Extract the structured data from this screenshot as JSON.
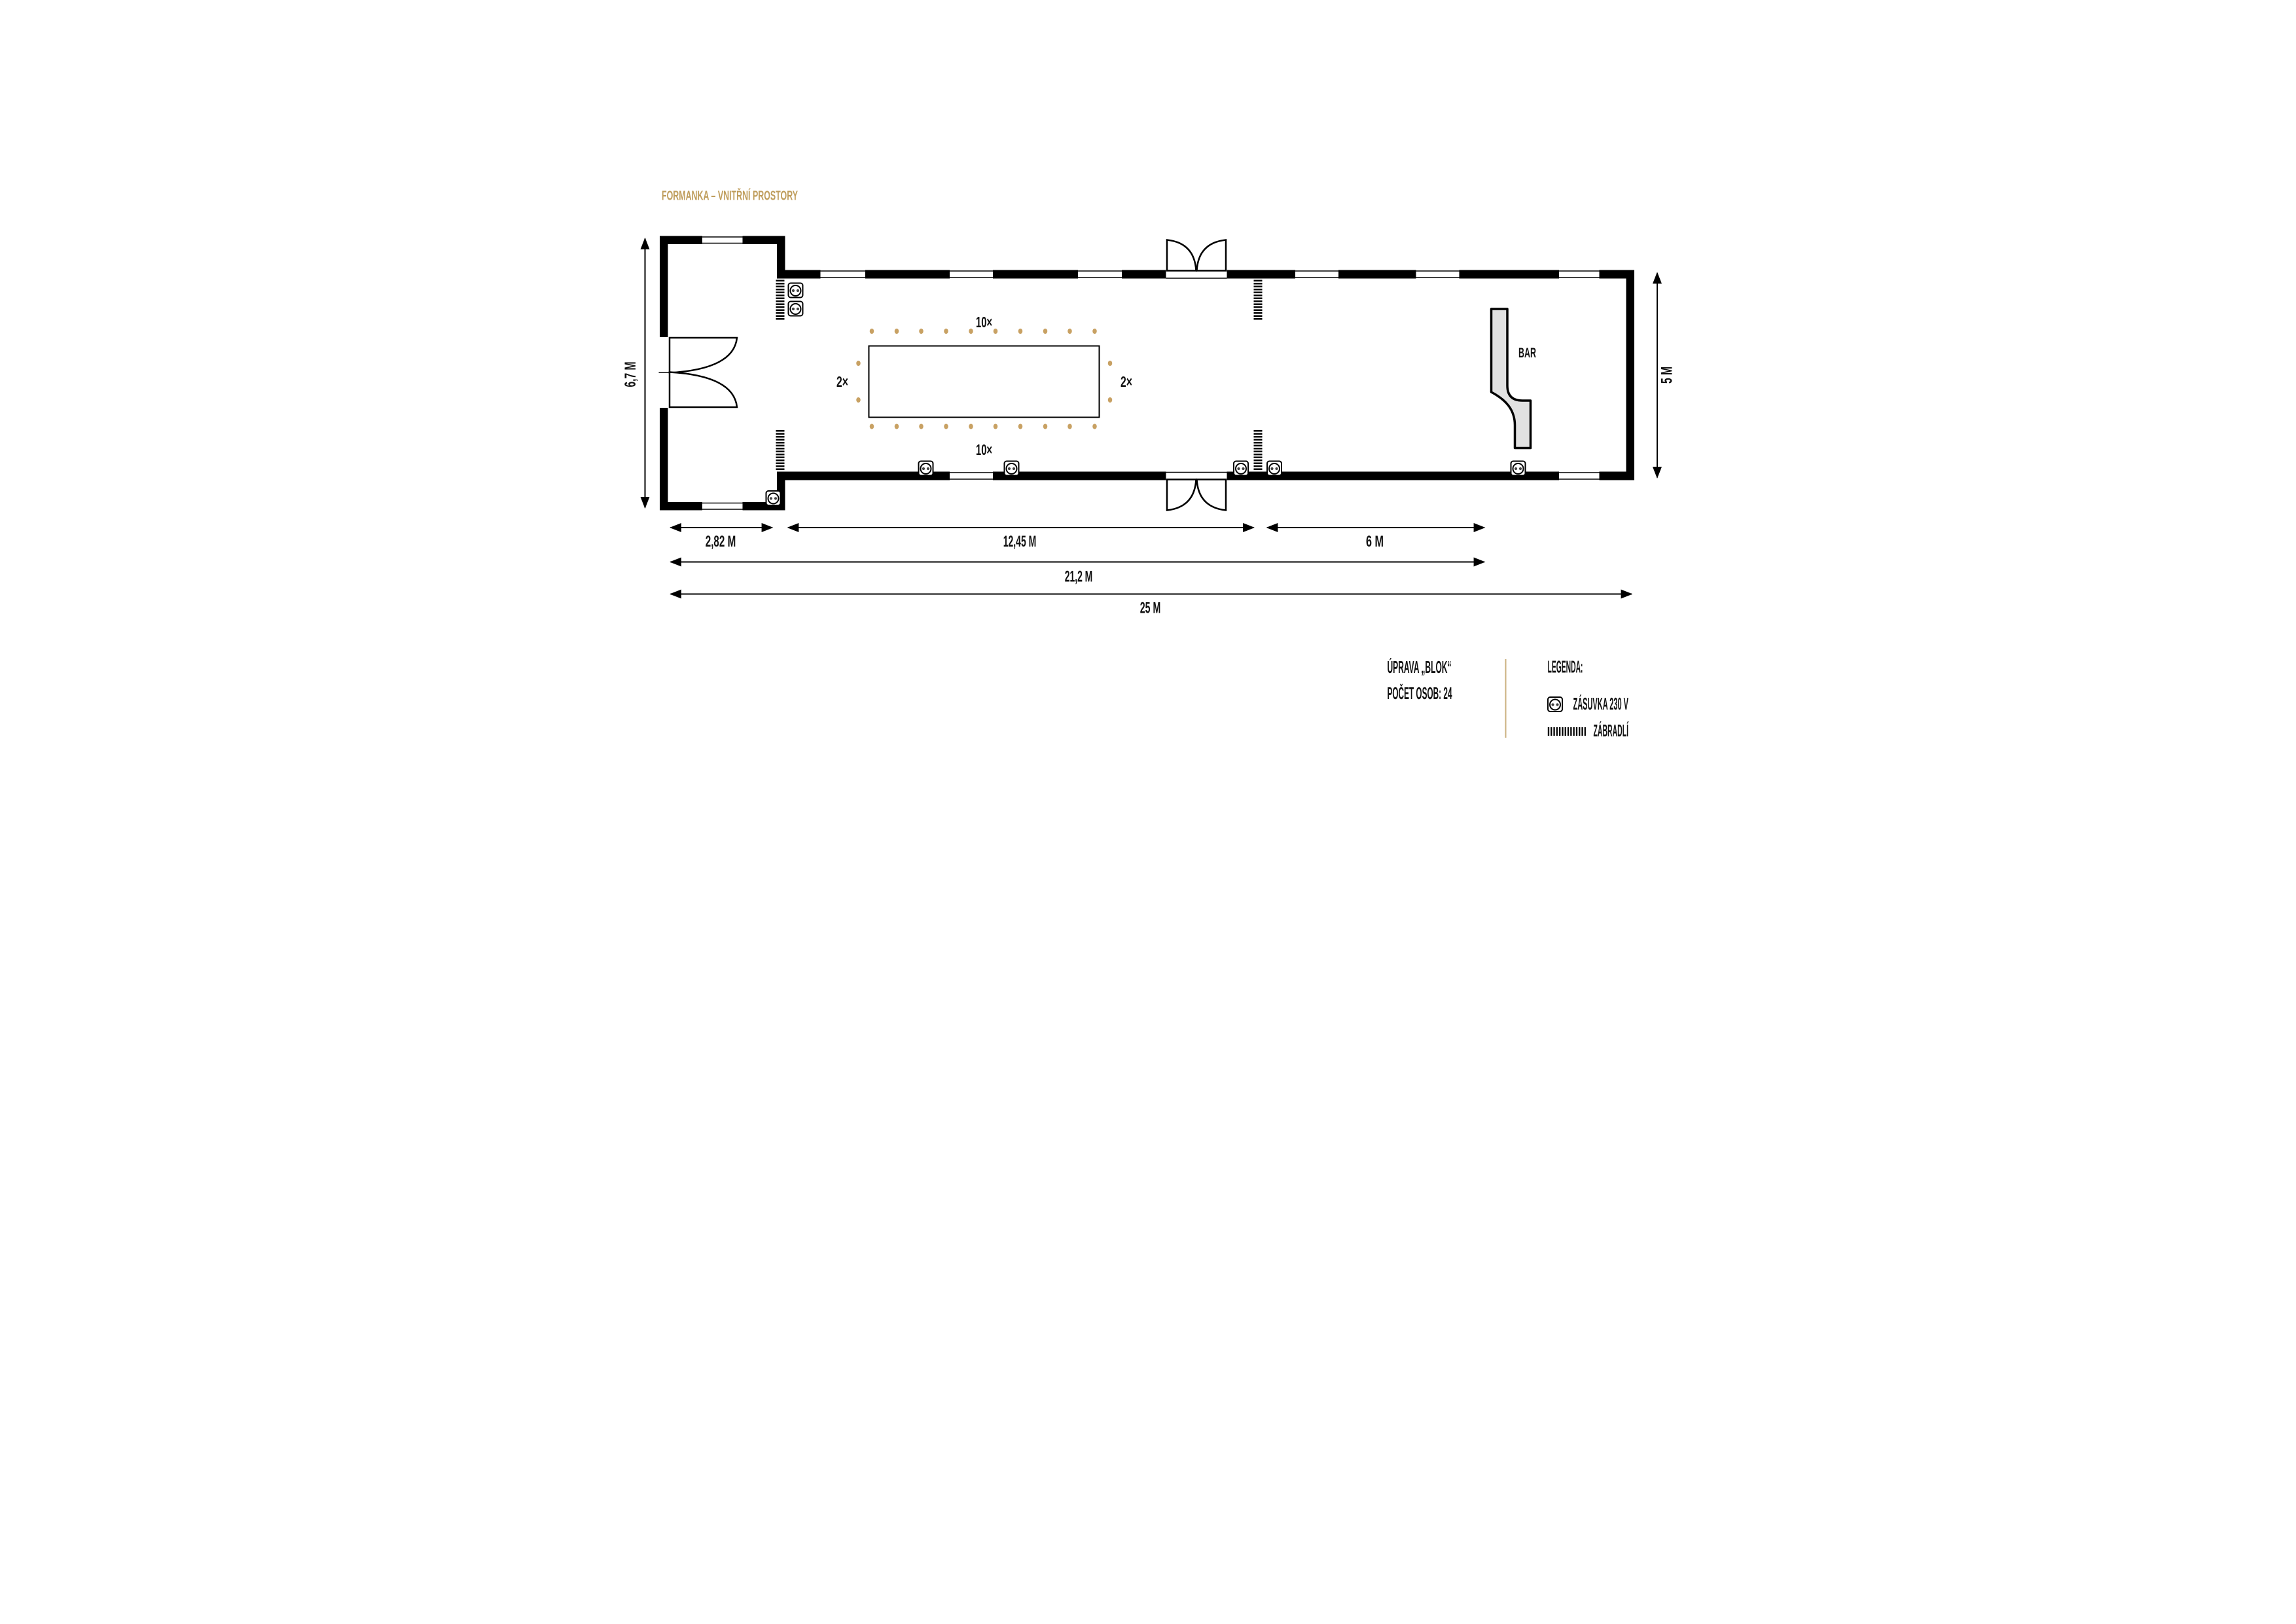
{
  "title": {
    "text": "FORMANKA – VNITŘNÍ PROSTORY",
    "color": "#bf9d5c"
  },
  "floor_plan": {
    "bar_label": "BAR",
    "seating": {
      "top_count_label": "10×",
      "bottom_count_label": "10×",
      "left_count_label": "2×",
      "right_count_label": "2×",
      "top_dots": 10,
      "bottom_dots": 10,
      "left_dots": 2,
      "right_dots": 2,
      "dot_color": "#c8a163"
    }
  },
  "dimensions": {
    "anteroom_width": "2,82 M",
    "hall_left_section": "12,45 M",
    "hall_right_section": "6 M",
    "inner_span": "21,2 M",
    "total_length": "25 M",
    "anteroom_height": "6,7 M",
    "hall_height": "5 M"
  },
  "notes": {
    "arrangement": "ÚPRAVA „BLOK“",
    "persons": "POČET OSOB: 24"
  },
  "legend": {
    "heading": "LEGENDA:",
    "items": [
      {
        "icon": "socket-icon",
        "label": "ZÁSUVKA 230 V"
      },
      {
        "icon": "railing-icon",
        "label": "ZÁBRADLÍ"
      }
    ]
  },
  "colors": {
    "accent_gold": "#bf9d5c",
    "wall_black": "#000000",
    "bar_fill": "#e1e1e1",
    "divider_gold": "#cbb280",
    "seat_dot": "#c8a163"
  }
}
